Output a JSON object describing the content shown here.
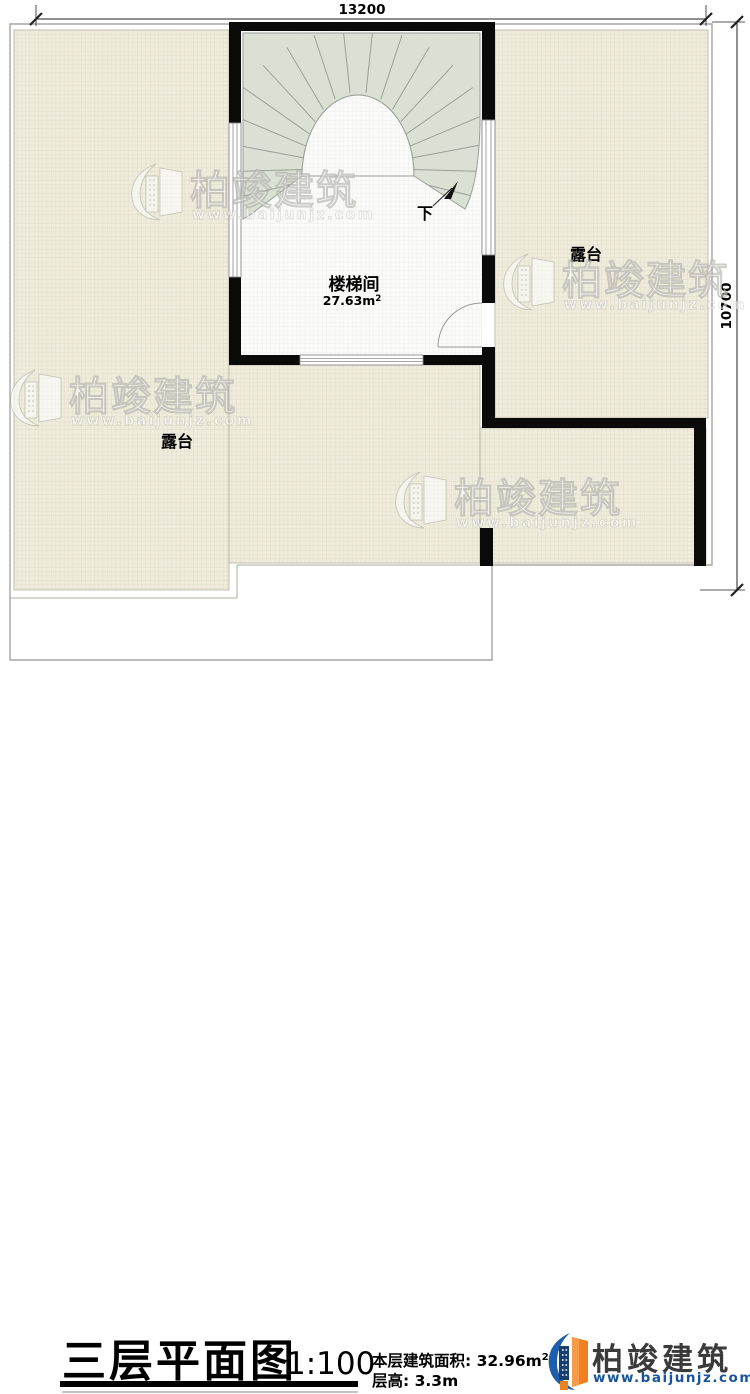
{
  "plan": {
    "dim_width": "13200",
    "dim_height": "10700",
    "stairwell_label": "楼梯间",
    "stairwell_area": "27.63m",
    "stairwell_area_sup": "2",
    "terrace_right_label": "露台",
    "terrace_left_label": "露台",
    "stair_direction": "下"
  },
  "watermark": {
    "brand": "柏竣建筑",
    "url": "www.baijunjz.com"
  },
  "title_block": {
    "title": "三层平面图",
    "scale": "1:100",
    "area_label": "本层建筑面积:",
    "area_value": "32.96m",
    "area_sup": "2",
    "height_label": "层高:",
    "height_value": "3.3m",
    "brand": "柏竣建筑",
    "brand_url": "www.baijunjz.com"
  },
  "colors": {
    "wall": "#0a0a0a",
    "tile": "#efecdd",
    "tile_line": "#dcd8c2",
    "floor": "#fbfbfa",
    "floor_line": "#e9e9e6",
    "stair": "#dbe0d5",
    "stair_line": "#9aa096",
    "outline": "#a5a5a3",
    "accent_orange": "#f08120",
    "accent_blue": "#1d5fae"
  }
}
